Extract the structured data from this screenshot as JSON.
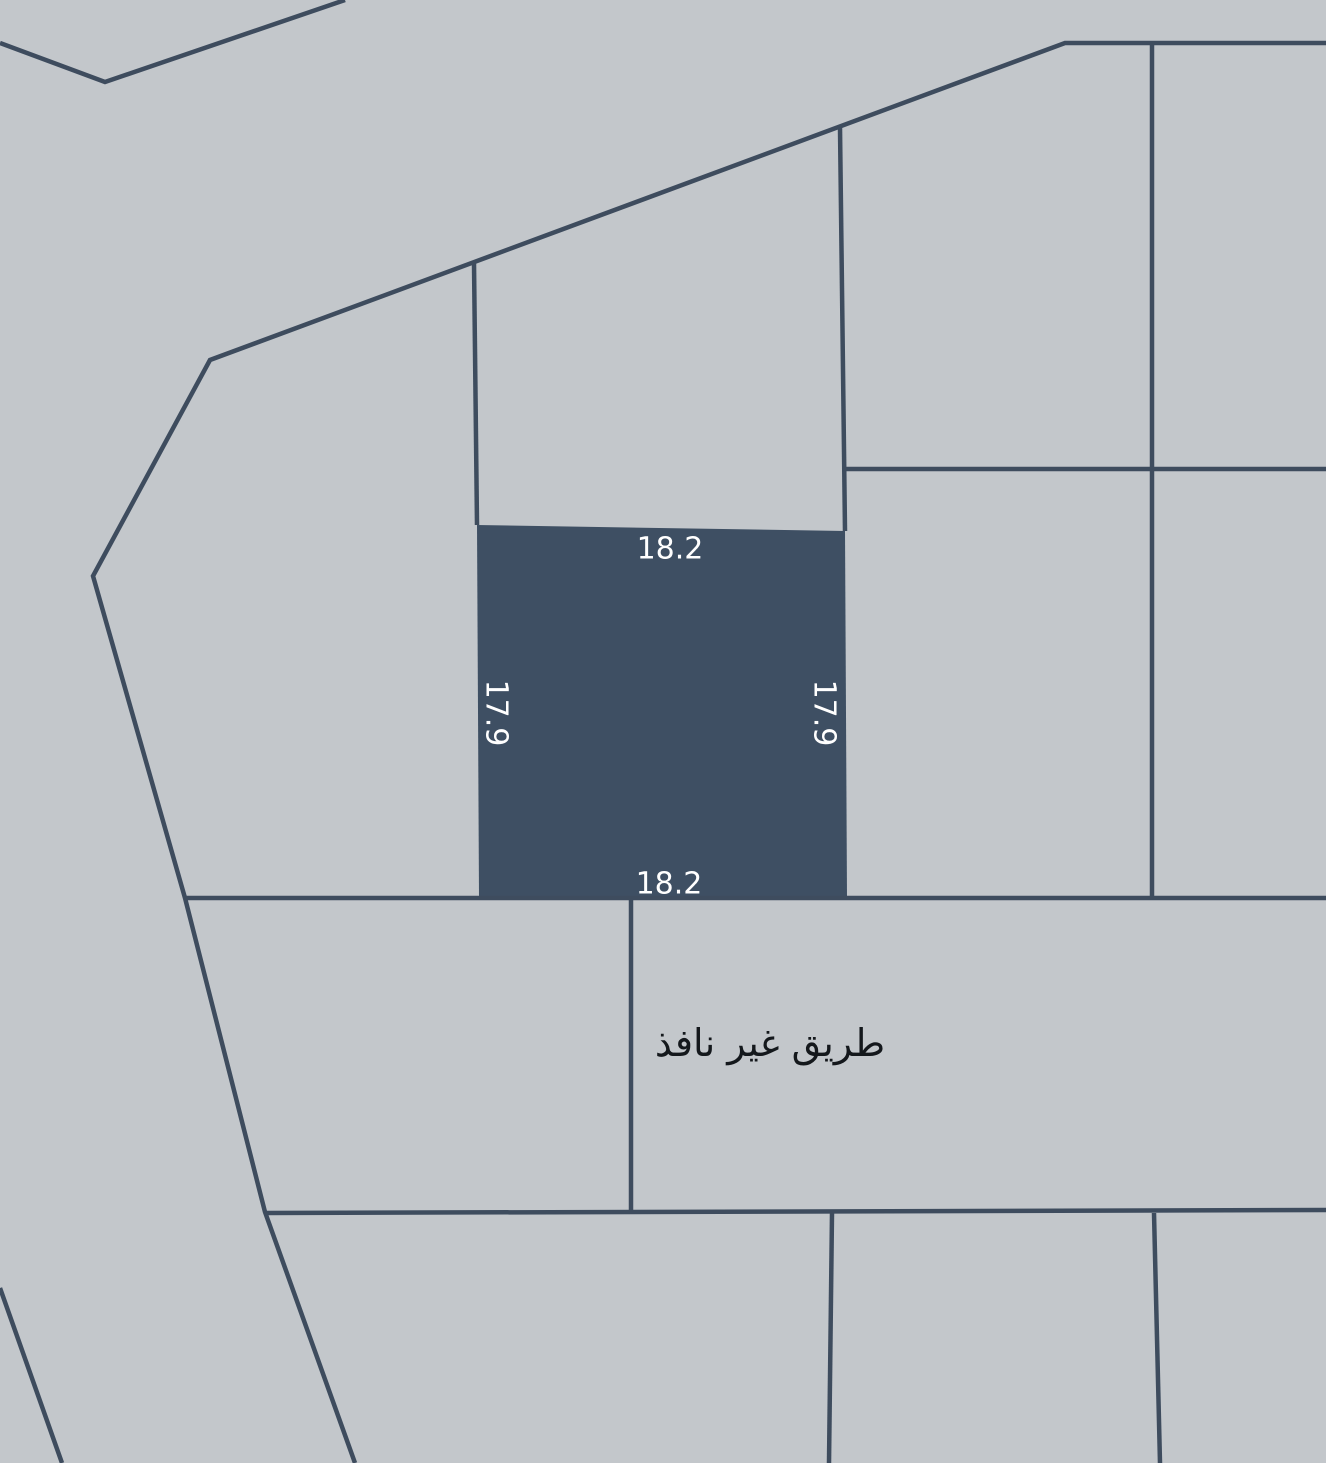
{
  "map": {
    "background_color": "#c3c7cb",
    "line_color": "#3e4c5e",
    "line_width": 4.5,
    "canvas": {
      "width": 1326,
      "height": 1463
    },
    "boundary_lines": [
      {
        "name": "northwest-corner-boundary",
        "points": [
          [
            0,
            43
          ],
          [
            105,
            82
          ],
          [
            345,
            0
          ]
        ]
      },
      {
        "name": "main-block-boundary",
        "points": [
          [
            1326,
            43
          ],
          [
            1065,
            43
          ],
          [
            210,
            360
          ],
          [
            93,
            576
          ],
          [
            185,
            898
          ],
          [
            265,
            1212
          ],
          [
            355,
            1463
          ]
        ]
      },
      {
        "name": "parcel-divider-above-plot-west",
        "points": [
          [
            474,
            263
          ],
          [
            477,
            525
          ]
        ]
      },
      {
        "name": "parcel-divider-above-plot-east",
        "points": [
          [
            840,
            128
          ],
          [
            845,
            531
          ]
        ]
      },
      {
        "name": "parcel-divider-horizontal-east",
        "points": [
          [
            843,
            469
          ],
          [
            1326,
            469
          ]
        ]
      },
      {
        "name": "parcel-divider-vertical-east",
        "points": [
          [
            1152,
            43
          ],
          [
            1152,
            898
          ]
        ]
      },
      {
        "name": "road-north-edge",
        "points": [
          [
            185,
            898
          ],
          [
            1326,
            898
          ]
        ]
      },
      {
        "name": "road-middle-divider",
        "points": [
          [
            631,
            899
          ],
          [
            631,
            1212
          ]
        ]
      },
      {
        "name": "road-south-edge",
        "points": [
          [
            265,
            1213
          ],
          [
            1326,
            1210
          ]
        ]
      },
      {
        "name": "south-parcel-divider-west",
        "points": [
          [
            832,
            1213
          ],
          [
            829,
            1463
          ]
        ]
      },
      {
        "name": "south-parcel-divider-east",
        "points": [
          [
            1154,
            1213
          ],
          [
            1160,
            1463
          ]
        ]
      },
      {
        "name": "southwest-corner-boundary",
        "points": [
          [
            0,
            1288
          ],
          [
            62,
            1463
          ]
        ]
      }
    ],
    "highlighted_plot": {
      "fill_color": "#3e4f63",
      "points": [
        [
          477,
          525
        ],
        [
          845,
          531
        ],
        [
          847,
          897
        ],
        [
          479,
          897
        ]
      ],
      "dimensions": {
        "north": "18.2",
        "south": "18.2",
        "west": "17.9",
        "east": "17.9"
      }
    },
    "labels": [
      {
        "name": "plot-dimension-north",
        "text": "18.2",
        "x": 670,
        "y": 549,
        "rotate": 0,
        "color": "#ffffff",
        "font_size": 30
      },
      {
        "name": "plot-dimension-west",
        "text": "17.9",
        "x": 496,
        "y": 713,
        "rotate": 90,
        "color": "#ffffff",
        "font_size": 30
      },
      {
        "name": "plot-dimension-east",
        "text": "17.9",
        "x": 824,
        "y": 713,
        "rotate": 90,
        "color": "#ffffff",
        "font_size": 30
      },
      {
        "name": "plot-dimension-south",
        "text": "18.2",
        "x": 669,
        "y": 884,
        "rotate": 0,
        "color": "#ffffff",
        "font_size": 30
      },
      {
        "name": "road-label",
        "text": "طريق غير نافذ",
        "x": 770,
        "y": 1043,
        "rotate": 0,
        "color": "#14181c",
        "font_size": 38
      }
    ]
  }
}
